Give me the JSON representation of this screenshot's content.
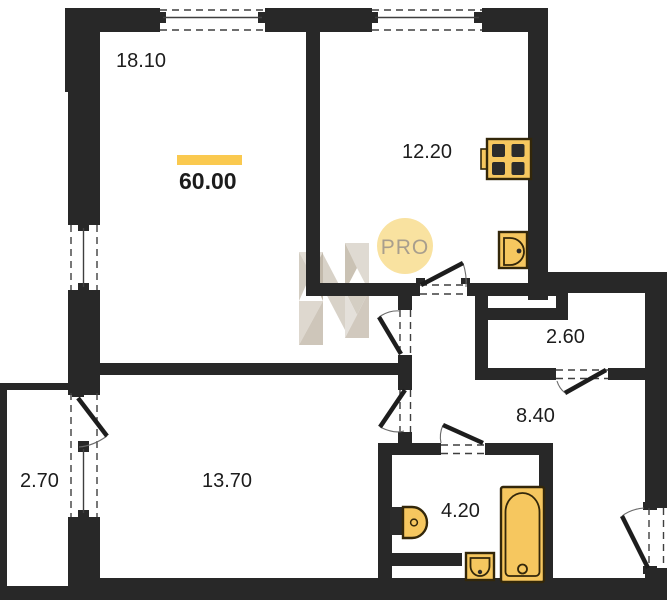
{
  "floor_plan": {
    "total_area": {
      "value": "60.00"
    },
    "rooms": [
      {
        "id": "living-room",
        "area": "18.10"
      },
      {
        "id": "kitchen",
        "area": "12.20"
      },
      {
        "id": "storage",
        "area": "2.60"
      },
      {
        "id": "hallway",
        "area": "8.40"
      },
      {
        "id": "bedroom",
        "area": "13.70"
      },
      {
        "id": "bathroom",
        "area": "4.20"
      },
      {
        "id": "balcony",
        "area": "2.70"
      }
    ],
    "watermark": {
      "badge_text": "PRO",
      "logo": "faceted-N-logo"
    },
    "fixtures": [
      "stove",
      "kitchen-sink",
      "toilet",
      "washbasin",
      "bathtub"
    ],
    "colors": {
      "wall": "#282828",
      "background": "#ffffff",
      "fixture_fill": "#f6c75f",
      "fixture_stroke": "#33270a",
      "area_highlight": "#fac94f",
      "pro_badge_fill": "#f9e2a0",
      "pro_badge_text": "#a89e8d",
      "label_text": "#1c1c1c",
      "watermark": "#cdc5b8"
    }
  }
}
